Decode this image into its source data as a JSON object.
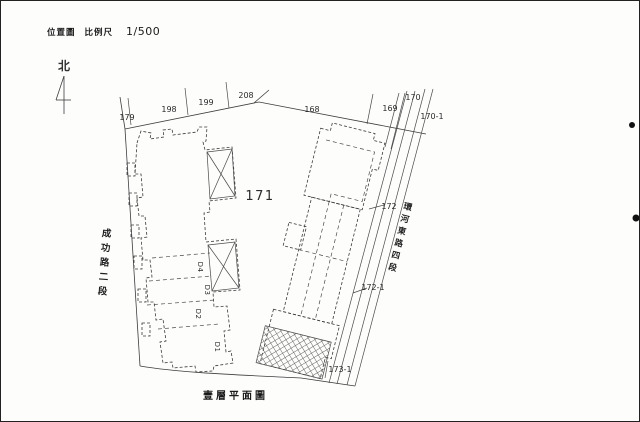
{
  "header": {
    "title": "位置圖",
    "scale_label": "比例尺",
    "scale_value": "1/500"
  },
  "north": {
    "label": "北"
  },
  "plan": {
    "parcels": {
      "179": "179",
      "198": "198",
      "199": "199",
      "208": "208",
      "168": "168",
      "169": "169",
      "170": "170",
      "170-1": "170-1",
      "171": "171",
      "172": "172",
      "172-1": "172-1",
      "173-1": "173-1"
    },
    "streets": {
      "west": "成功路二段",
      "east": "環河東路四段"
    },
    "units": {
      "d1": "D1",
      "d2": "D2",
      "d3": "D3",
      "d4": "D4"
    }
  },
  "caption": "壹層平面圖"
}
